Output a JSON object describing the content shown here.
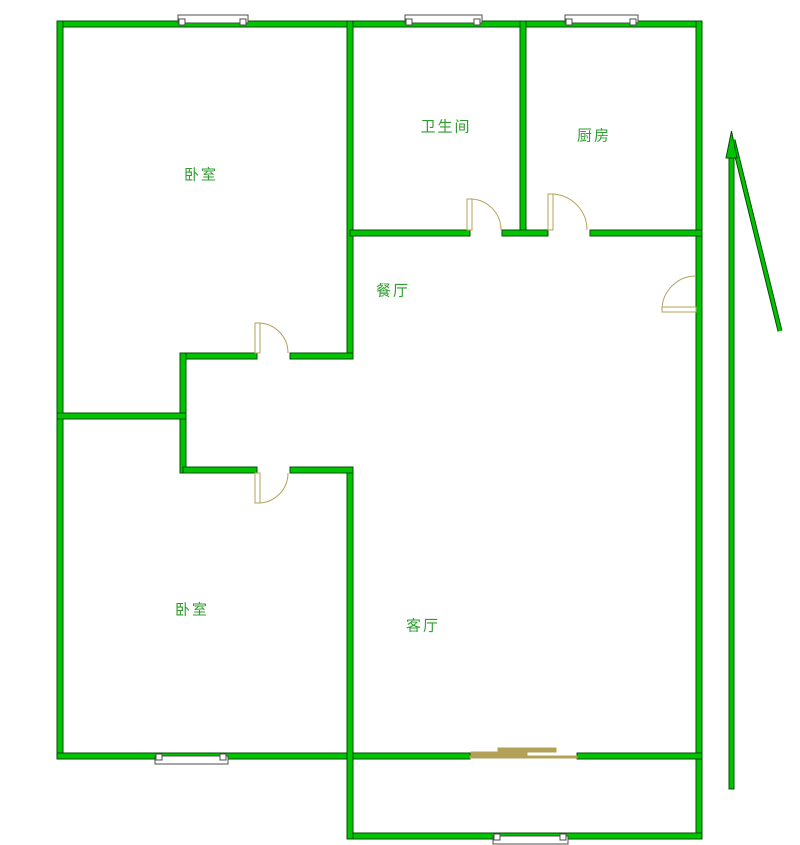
{
  "colors": {
    "background": "#ffffff",
    "wall_fill": "#00c400",
    "wall_edge": "#054d05",
    "door": "#b3a159",
    "window_border": "#4d4d4d",
    "window_fill": "#ffffff",
    "label_text": "#2f9e2f"
  },
  "rooms": [
    {
      "id": "bedroom-top",
      "label": "卧室",
      "cx": 201,
      "cy": 174
    },
    {
      "id": "bathroom",
      "label": "卫生间",
      "cx": 446,
      "cy": 126
    },
    {
      "id": "kitchen",
      "label": "厨房",
      "cx": 594,
      "cy": 135
    },
    {
      "id": "dining",
      "label": "餐厅",
      "cx": 393,
      "cy": 290
    },
    {
      "id": "bedroom-bottom",
      "label": "卧室",
      "cx": 192,
      "cy": 609
    },
    {
      "id": "living",
      "label": "客厅",
      "cx": 423,
      "cy": 625
    }
  ],
  "plan": {
    "width": 800,
    "height": 845,
    "walls": [
      [
        57,
        21,
        645,
        6
      ],
      [
        57,
        21,
        6,
        738
      ],
      [
        696,
        21,
        6,
        818
      ],
      [
        57,
        753,
        296,
        6
      ],
      [
        350,
        753,
        120,
        6
      ],
      [
        577,
        753,
        125,
        6
      ],
      [
        350,
        833,
        352,
        6
      ],
      [
        347,
        21,
        6,
        338
      ],
      [
        347,
        467,
        6,
        372
      ],
      [
        520,
        21,
        6,
        215
      ],
      [
        350,
        230,
        120,
        6
      ],
      [
        502,
        230,
        46,
        6
      ],
      [
        590,
        230,
        112,
        6
      ],
      [
        183,
        353,
        74,
        6
      ],
      [
        290,
        353,
        63,
        6
      ],
      [
        180,
        353,
        6,
        120
      ],
      [
        57,
        413,
        129,
        6
      ],
      [
        183,
        467,
        74,
        6
      ],
      [
        290,
        467,
        63,
        6
      ]
    ],
    "windows": [
      {
        "bar": [
          178,
          15,
          70,
          8
        ],
        "posts": [
          [
            179,
            19,
            6,
            6
          ],
          [
            240,
            19,
            6,
            6
          ]
        ]
      },
      {
        "bar": [
          405,
          15,
          77,
          8
        ],
        "posts": [
          [
            406,
            19,
            6,
            6
          ],
          [
            474,
            19,
            6,
            6
          ]
        ]
      },
      {
        "bar": [
          565,
          15,
          73,
          8
        ],
        "posts": [
          [
            566,
            19,
            6,
            6
          ],
          [
            630,
            19,
            6,
            6
          ]
        ]
      },
      {
        "bar": [
          155,
          756,
          73,
          8
        ],
        "posts": [
          [
            156,
            754,
            6,
            6
          ],
          [
            220,
            754,
            6,
            6
          ]
        ]
      },
      {
        "bar": [
          493,
          836,
          75,
          8
        ],
        "posts": [
          [
            494,
            834,
            6,
            6
          ],
          [
            560,
            834,
            6,
            6
          ]
        ]
      }
    ],
    "doors": [
      {
        "id": "door-bedroom-top",
        "leaf": [
          255,
          323,
          5,
          30
        ],
        "arc": "M 258 323 A 30 30 0 0 1 288 353"
      },
      {
        "id": "door-bedroom-bottom",
        "leaf": [
          255,
          473,
          5,
          30
        ],
        "arc": "M 258 503 A 30 30 0 0 0 288 473"
      },
      {
        "id": "door-bathroom",
        "leaf": [
          467,
          199,
          5,
          31
        ],
        "arc": "M 470 199 A 31 31 0 0 1 501 230"
      },
      {
        "id": "door-kitchen",
        "leaf": [
          548,
          194,
          5,
          36
        ],
        "arc": "M 551 194 A 36 36 0 0 1 587 230"
      },
      {
        "id": "door-entrance",
        "leaf": [
          662,
          307,
          34,
          5
        ],
        "arc": "M 662 310 A 34 34 0 0 1 696 276"
      }
    ],
    "sliding_door": {
      "rail": [
        470,
        756,
        107,
        2
      ],
      "panels": [
        [
          471,
          752,
          56,
          4
        ],
        [
          498,
          748,
          58,
          4
        ]
      ]
    },
    "north_arrow": {
      "head": "731.5,131 737,158 726,158",
      "shaft": [
        729,
        152,
        5,
        637
      ],
      "tail": [
        733,
        140,
        780,
        331
      ]
    }
  }
}
